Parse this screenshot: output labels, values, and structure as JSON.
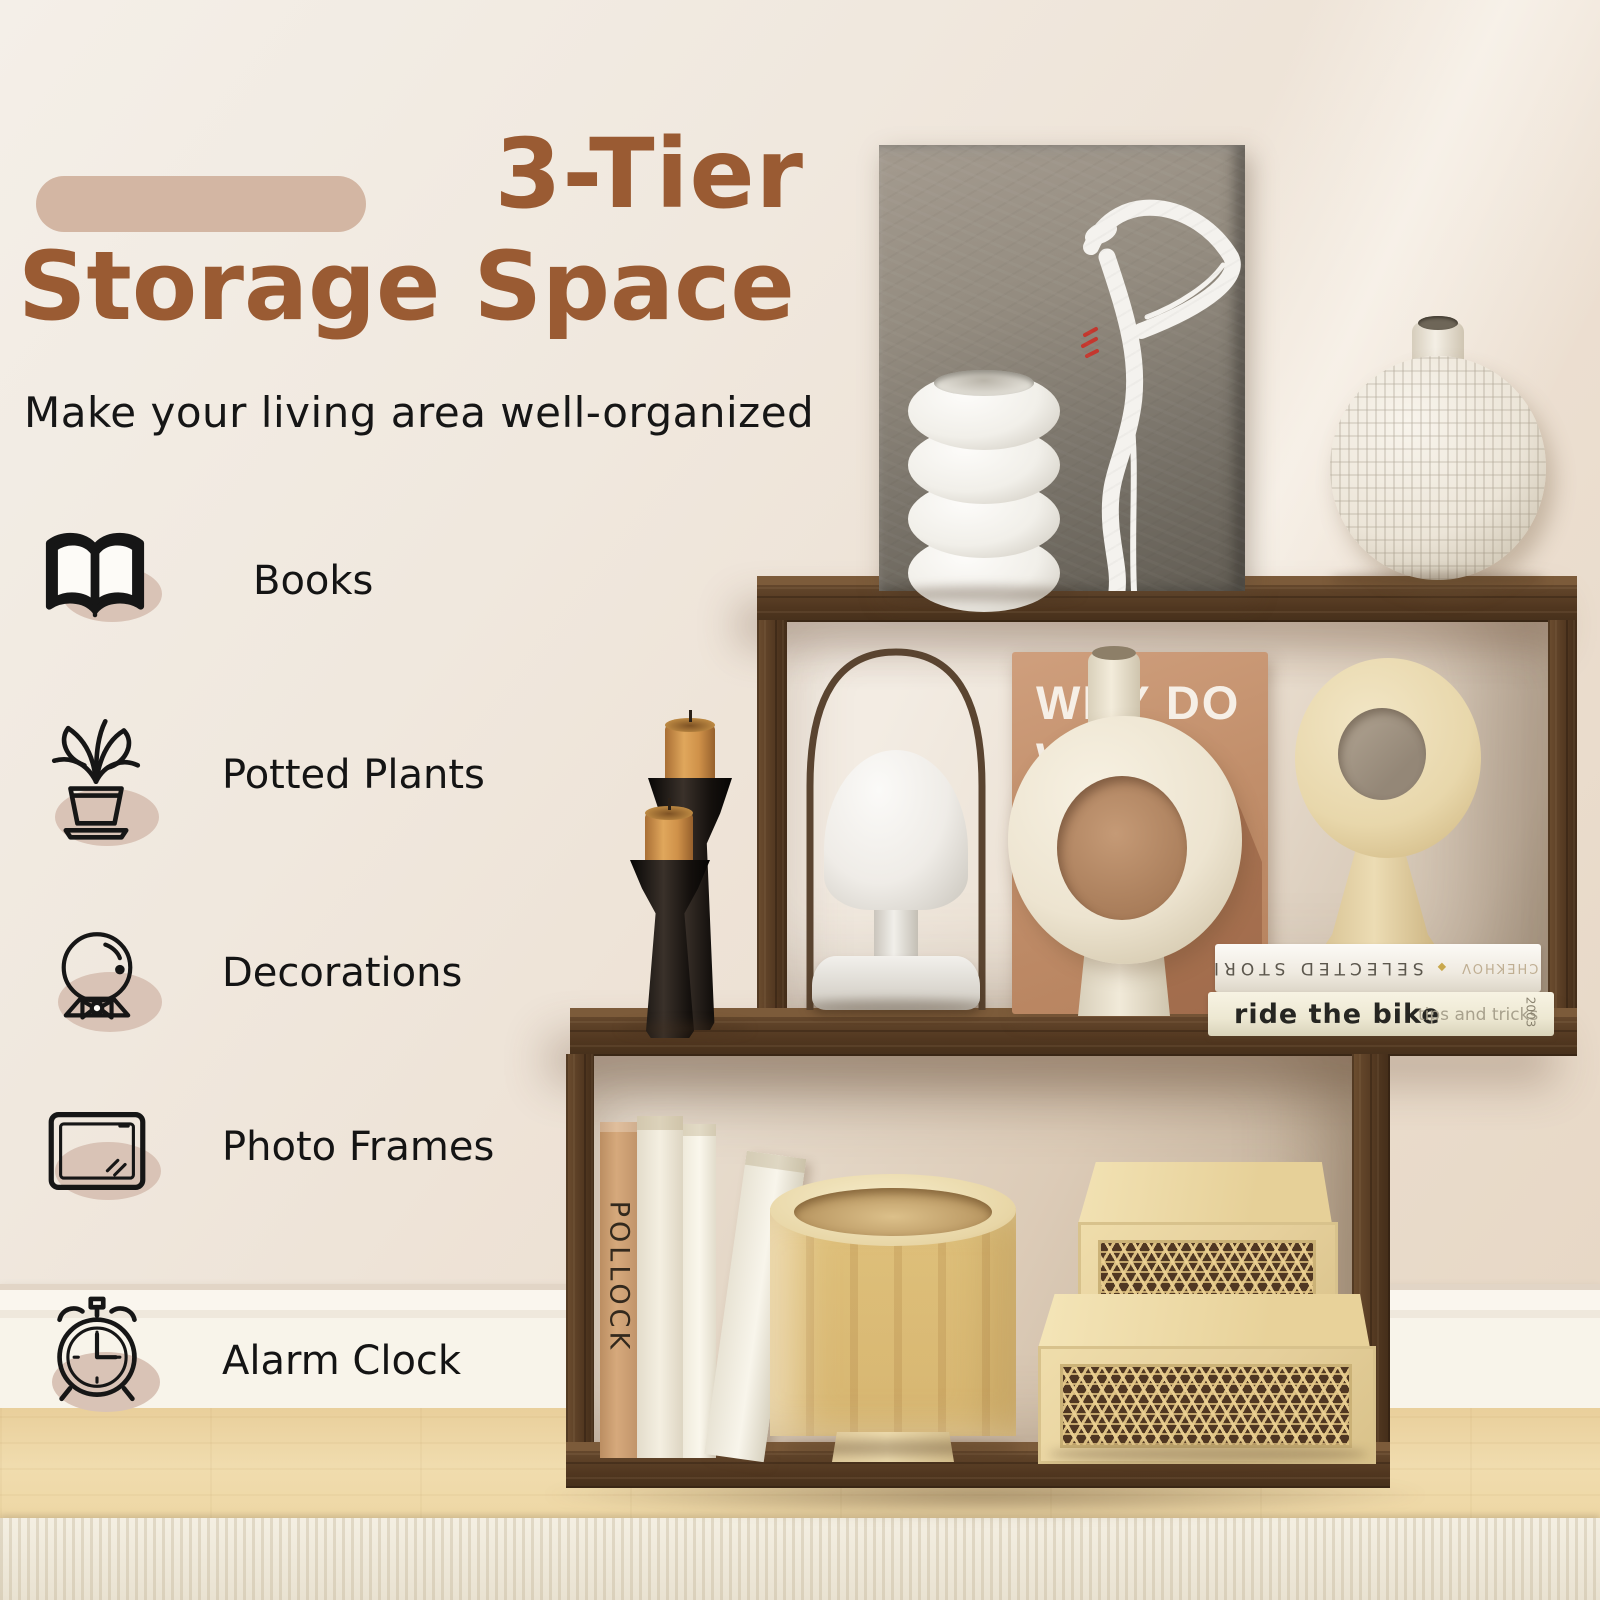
{
  "title": {
    "line1": "3-Tier",
    "line2": "Storage Space",
    "subtitle": "Make your living area well-organized"
  },
  "features": [
    {
      "icon": "open-book-icon",
      "label": "Books"
    },
    {
      "icon": "potted-plant-icon",
      "label": "Potted Plants"
    },
    {
      "icon": "snow-globe-icon",
      "label": "Decorations"
    },
    {
      "icon": "photo-frame-icon",
      "label": "Photo Frames"
    },
    {
      "icon": "alarm-clock-icon",
      "label": "Alarm Clock"
    }
  ],
  "scene": {
    "magazine": {
      "lines": [
        "WHY DO",
        "WE VE",
        "CA"
      ]
    },
    "book_stack": {
      "spine_top": {
        "title": "SELECTED STORIES",
        "author": "ANTON CHEKHOV",
        "ornament": "◆"
      },
      "spine_bottom": {
        "title": "ride the bike",
        "subtitle": "tips and tricks",
        "edge_text": "2003"
      }
    },
    "vertical_book": {
      "spine": "POLLOCK"
    }
  },
  "colors": {
    "accent_brown": "#9a5b33",
    "pill_tan": "#d3b6a3",
    "icon_shadow": "#d9c3b6",
    "text_black": "#141414",
    "shelf_wood": "#553a22",
    "floor_wood": "#eed7a4",
    "wall_cream": "#f1eae1"
  }
}
